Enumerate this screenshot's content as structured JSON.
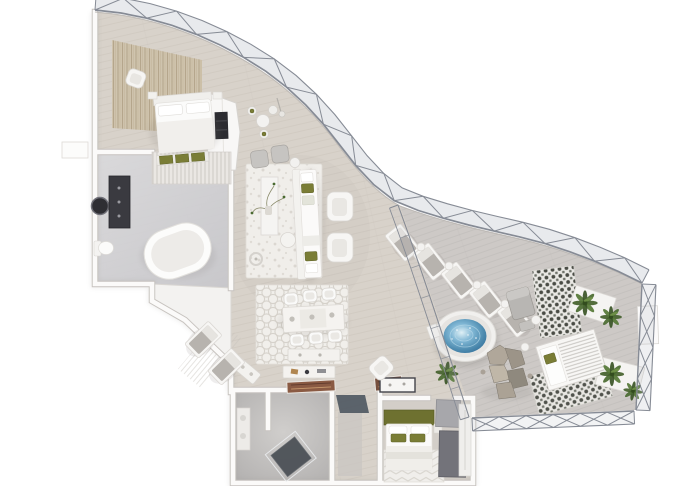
{
  "meta": {
    "description": "Photorealistic 3D rendered top-down floor plan of a luxury penthouse suite with a curved steel-truss glass facade, master bedroom, marble bathroom, open living and dining areas, second bedroom and bathroom, and a large terrace with chaise lounges, a round jacuzzi, rock sculpture, cabana daybed and potted ferns",
    "background": "#ffffff",
    "render_style": "axonometric architectural visualization, no text labels"
  },
  "palette": {
    "floor": "#d8d2ca",
    "terrace": "#cdc9c6",
    "wall": "#fbfaf9",
    "wall_edge": "#c7c3bf",
    "steel": "#868b95",
    "glass": "#aeb3bd",
    "water": "#7fb6d4",
    "plant": "#4a6a31",
    "olive": "#7a7d36",
    "olive_dark": "#6e7130",
    "marble": "#d2d2d6",
    "rug": "#f0eeea",
    "rock": "#a39b8e",
    "slate": "#4e5660",
    "dark_fixture": "#3a3a40"
  },
  "structure": {
    "facade": "curved glass wall with warren steel truss running from upper-left to mid-right",
    "right_frame": "x-lattice steel frame around terrace edge",
    "inner_brace": "thin diagonal mullion band separating living area from terrace"
  },
  "rooms": [
    {
      "name": "master-bedroom",
      "features": [
        "double-bed",
        "foot-bench-olive-cushions",
        "armchair",
        "textured-tan-wall-panels",
        "nightstands"
      ]
    },
    {
      "name": "master-bathroom",
      "features": [
        "freestanding-bathtub",
        "dark-vanity-cabinet",
        "round-mirror",
        "toilet",
        "marble-floor",
        "slatted-closet-band"
      ]
    },
    {
      "name": "living-room",
      "features": [
        "long-sofa-olive-pillows",
        "two-white-armchairs",
        "console-with-branch-decor",
        "floor-lamp",
        "coffee-table",
        "speckled-white-rug",
        "gray-armchair-pair",
        "bistro-chair-set"
      ]
    },
    {
      "name": "dining-room",
      "features": [
        "rectangular-table",
        "six-bucket-chairs",
        "lattice-rug",
        "sideboard"
      ]
    },
    {
      "name": "foyer",
      "features": [
        "console-table",
        "flat-artwork-rugs",
        "rotated-bench",
        "slate-floor-inlay",
        "white-desk-dark-frame",
        "white-armchair"
      ]
    },
    {
      "name": "second-bathroom",
      "features": [
        "dark-walk-in-shower",
        "vanity",
        "smoked-stone-floor"
      ]
    },
    {
      "name": "second-bedroom",
      "features": [
        "bed-olive-headboard",
        "olive-cushions",
        "chevron-rug",
        "gray-wardrobe-volumes"
      ]
    },
    {
      "name": "terrace",
      "features": [
        "chaise-lounge-row",
        "round-jacuzzi",
        "rock-sculpture",
        "cabana-daybed-slatted-roof",
        "potted-ferns",
        "patterned-tile-bands",
        "gray-lounge-chair",
        "white-planters"
      ]
    }
  ],
  "terrace": {
    "chaise_lounges": 5,
    "side_tables": 4,
    "ferns": 5,
    "tile_bands": 2,
    "jacuzzi": {
      "shape": "round",
      "water_color": "#7fb6d4"
    }
  },
  "dining": {
    "chairs": 6,
    "place_settings": 3
  },
  "foyer_deck": {
    "chaises": 2
  }
}
